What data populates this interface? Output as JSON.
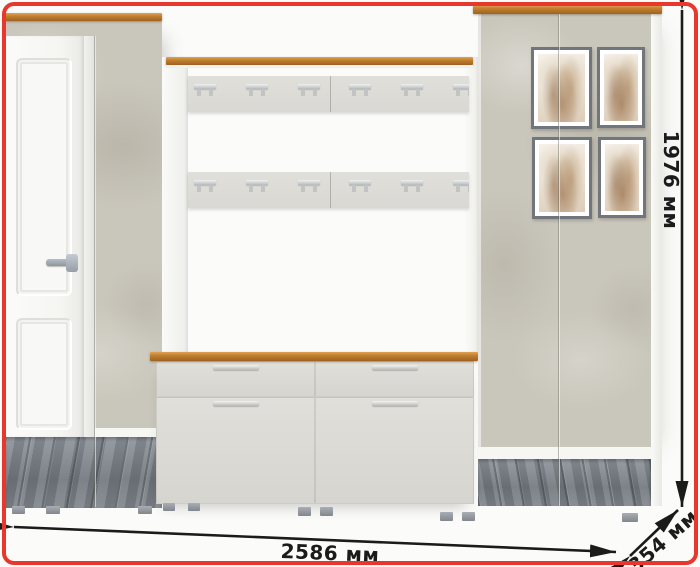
{
  "scene": {
    "description": "hallway storage furniture set render",
    "pieces": {
      "left_wardrobe": "wardrobe with white classic paneled door, concrete-finish door and mirrored base",
      "coat_rack": "wall panel with wood shelf and two rails of metal double hooks",
      "shoe_bench": "bench with two drawers and two flap doors, oak top",
      "right_wardrobe": "two-door wardrobe with concrete finish, four botanical art prints and mirrored base"
    },
    "counts": {
      "hook_rows": 2,
      "hooks_per_row": 6,
      "art_prints": 4,
      "bench_drawers": 2,
      "bench_doors": 2
    }
  },
  "dimensions": {
    "width_label": "2586 мм",
    "height_label": "1976 мм",
    "depth_label": "354 мм"
  },
  "colors": {
    "accent_border": "#e8372c",
    "dimension_ink": "#1b1b1b",
    "wood": "#c0802f",
    "concrete": "#c9c6bb",
    "front_panel": "#d9d8d3",
    "mirror_floor": "#7d8388",
    "wall": "#fbfbf9"
  }
}
